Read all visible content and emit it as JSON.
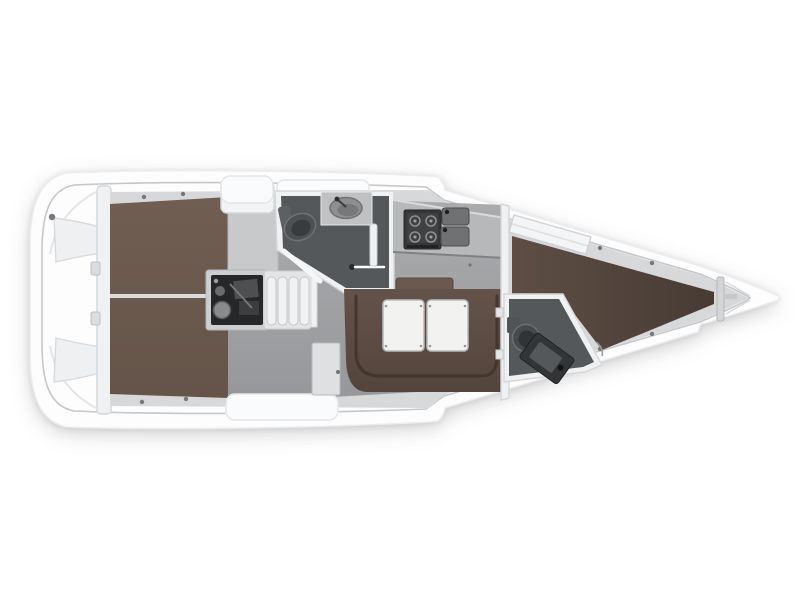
{
  "page": {
    "background": "#ffffff",
    "description": "Top-view interior layout plan of a sailing yacht, bow pointing right, no text labels"
  },
  "colors": {
    "canvas_bg": "#ffffff",
    "hull_fill": "#fdfdfe",
    "hull_stroke": "#ececee",
    "inner_line": "#c6c7c9",
    "floor_top": "#abacae",
    "floor_bottom": "#96979a",
    "counter": "#b7b8ba",
    "berth_aft": "#6d5b51",
    "berth_fwd_light": "#5e4e45",
    "berth_fwd_dark": "#473b33",
    "settee": "#5f4e45",
    "settee_line": "#3e332c",
    "backrest": "#6b5950",
    "head_floor": "#55585b",
    "appliance_dark": "#343638",
    "engine_dark": "#262729",
    "fixture_gray": "#6f7173",
    "white_furniture": "#f2f3f4",
    "table": "#f2f2f0",
    "dot": "#76777a",
    "cabinet": "#c8c9cb"
  },
  "regions": {
    "stern_platform": "Stern swim platform",
    "transom_lockers": "Transom lockers",
    "aft_cabin_berth": "Aft cabin double berth",
    "berth_divider": "Aft berth centre divider",
    "engine_compartment": "Engine compartment",
    "companionway_steps": "Companionway steps",
    "aft_head": "Aft head with toilet, washbasin and shower",
    "galley": "Galley with stove and double sink",
    "salon": "Salon with U-settee and folding table",
    "side_cabinet": "Salon side cabinet",
    "main_bulkhead": "Main bulkhead with door",
    "forward_cabin_berth": "Forward cabin V-berth",
    "forward_head": "Forward head with toilet and washbasin",
    "anchor_locker": "Bow anchor locker"
  }
}
